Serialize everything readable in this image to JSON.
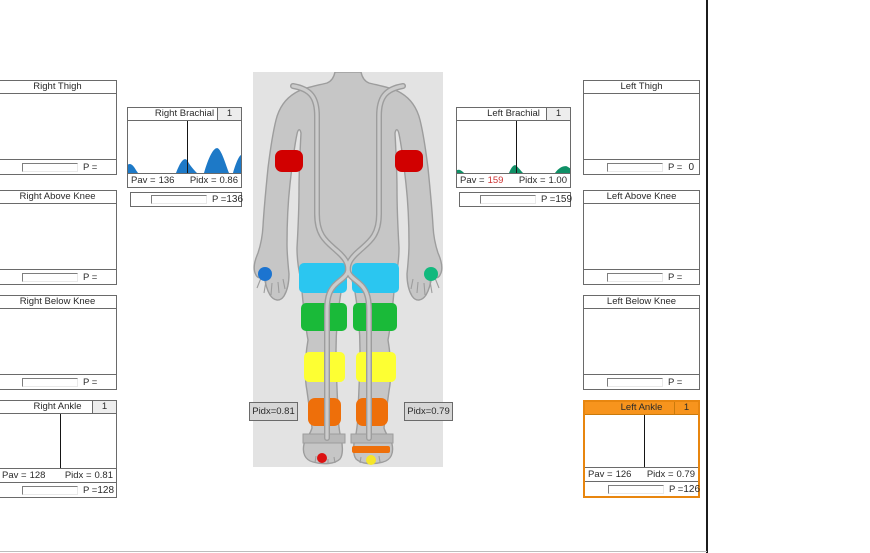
{
  "panels": {
    "right_thigh": {
      "title": "Right Thigh",
      "p_label": "P =",
      "p_value": ""
    },
    "right_above_knee": {
      "title": "Right Above Knee",
      "p_label": "P =",
      "p_value": ""
    },
    "right_below_knee": {
      "title": "Right Below Knee",
      "p_label": "P =",
      "p_value": ""
    },
    "left_thigh": {
      "title": "Left Thigh",
      "p_label": "P =",
      "p_value": "0"
    },
    "left_above_knee": {
      "title": "Left Above Knee",
      "p_label": "P =",
      "p_value": ""
    },
    "left_below_knee": {
      "title": "Left Below Knee",
      "p_label": "P =",
      "p_value": ""
    },
    "right_brachial": {
      "title": "Right Brachial",
      "badge": "1",
      "pav_label": "Pav =",
      "pav_value": "136",
      "pidx_label": "Pidx =",
      "pidx_value": "0.86",
      "p_label": "P =",
      "p_value": "136"
    },
    "left_brachial": {
      "title": "Left Brachial",
      "badge": "1",
      "pav_label": "Pav =",
      "pav_value": "159",
      "pidx_label": "Pidx =",
      "pidx_value": "1.00",
      "p_label": "P =",
      "p_value": "159"
    },
    "right_ankle": {
      "title": "Right Ankle",
      "badge": "1",
      "pav_label": "Pav =",
      "pav_value": "128",
      "pidx_label": "Pidx =",
      "pidx_value": "0.81",
      "p_label": "P =",
      "p_value": "128"
    },
    "left_ankle": {
      "title": "Left Ankle",
      "badge": "1",
      "pav_label": "Pav =",
      "pav_value": "126",
      "pidx_label": "Pidx =",
      "pidx_value": "0.79",
      "p_label": "P =",
      "p_value": "126"
    }
  },
  "body_diagram": {
    "right_ankle_pidx_label": "Pidx=0.81",
    "left_ankle_pidx_label": "Pidx=0.79"
  },
  "colors": {
    "highlight_orange": "#f7941d",
    "cuff_brachial_red": "#d10000",
    "cuff_thigh_cyan": "#2bc6f0",
    "cuff_above_knee_green": "#1aba39",
    "cuff_below_knee_yellow": "#fdff33",
    "cuff_ankle_orange": "#ee6f0a",
    "marker_right_hand_blue": "#1c74d0",
    "marker_left_hand_teal": "#12b97e",
    "marker_right_foot_red": "#dc1212",
    "marker_left_foot_yellow": "#f6e62a",
    "waveform_right_blue": "#1d79c7",
    "waveform_left_green": "#0f9066",
    "alert_value_red": "#cc3333"
  }
}
